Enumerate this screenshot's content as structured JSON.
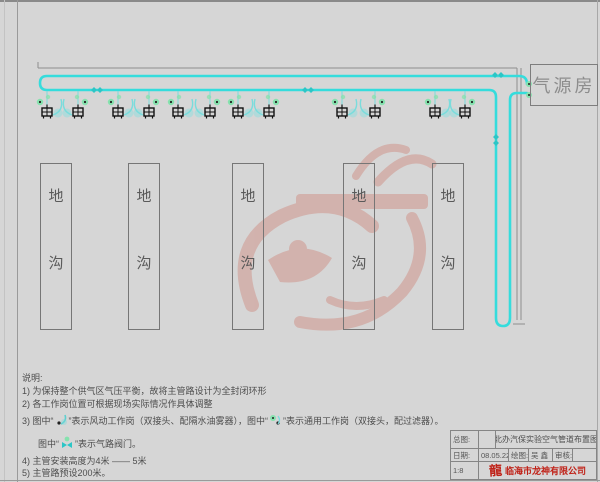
{
  "sheet": {
    "background": "#d6d6d6",
    "frame_color": "#9a9a9a"
  },
  "air_room": {
    "label": "气源房"
  },
  "trenches": {
    "label_chars": [
      "地",
      "沟"
    ],
    "top": 163,
    "width": 30,
    "height": 165,
    "items": [
      {
        "x": 40
      },
      {
        "x": 128
      },
      {
        "x": 232
      },
      {
        "x": 343
      },
      {
        "x": 432
      }
    ]
  },
  "pipeline": {
    "color": "#35dcdc",
    "accessory_color": "#7adcdc",
    "valve_color": "#2cc6c6",
    "station_green": "#86e2ae",
    "stations": [
      {
        "x": 47,
        "m": false
      },
      {
        "x": 78,
        "m": true
      },
      {
        "x": 118,
        "m": false
      },
      {
        "x": 149,
        "m": true
      },
      {
        "x": 178,
        "m": false
      },
      {
        "x": 210,
        "m": true
      },
      {
        "x": 238,
        "m": false
      },
      {
        "x": 269,
        "m": true
      },
      {
        "x": 342,
        "m": false
      },
      {
        "x": 375,
        "m": true
      },
      {
        "x": 435,
        "m": false
      },
      {
        "x": 465,
        "m": true
      }
    ],
    "valves": [
      {
        "x": 97,
        "y": 90,
        "o": "h"
      },
      {
        "x": 308,
        "y": 90,
        "o": "h"
      },
      {
        "x": 498,
        "y": 75,
        "o": "h"
      },
      {
        "x": 496,
        "y": 140,
        "o": "v"
      }
    ]
  },
  "watermark": {
    "color": "#c8503c"
  },
  "notes": {
    "heading": "说明:",
    "n1": "1) 为保持整个供气区气压平衡，故将主管路设计为全封闭环形",
    "n2": "2) 各工作岗位置可根据现场实际情况作具体调整",
    "n3": {
      "p1": "3) 图中“",
      "p2": "”表示风动工作岗（双接头、配隔水油雾器），图中“",
      "p3": "”表示通用工作岗（双接头，配过滤器）。"
    },
    "n3b": {
      "p1": "图中“",
      "p2": "”表示气路阀门。"
    },
    "n4": "4) 主管安装高度为4米 —— 5米",
    "n5": "5) 主管路预设200米。"
  },
  "title_block": {
    "r1c1": "总图:",
    "r1c2": "",
    "r1c3": "北办汽保实验空气管道布置图",
    "r2c1": "日期:",
    "r2c2": "08.05.22",
    "r2c3": "绘图:",
    "r2c4": "吴 鑫",
    "r2c5": "审核:",
    "r2c6": "",
    "r3c1": "1:8",
    "company": "临海市龙神有限公司"
  }
}
